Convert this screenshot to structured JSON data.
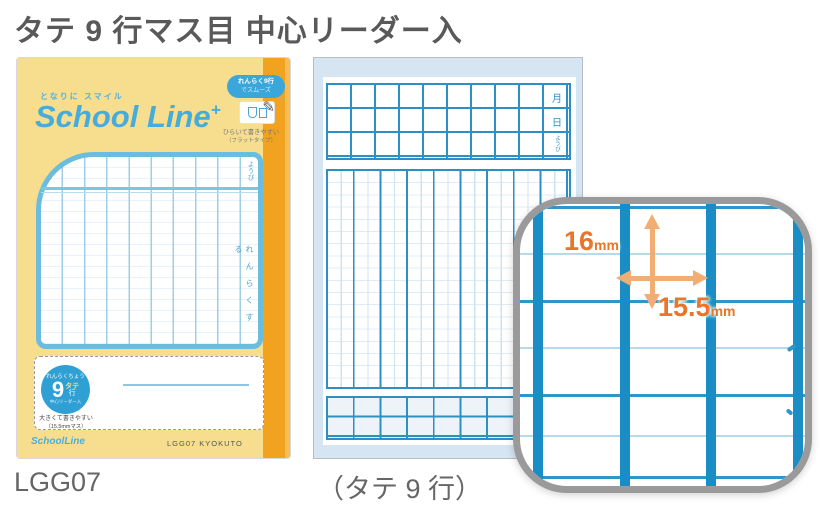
{
  "page": {
    "title": "タテ 9 行マス目 中心リーダー入",
    "product_code": "LGG07",
    "variant_caption": "（タテ 9 行）"
  },
  "cover": {
    "tagline": "となりに スマイル",
    "brand": "School Line",
    "brand_plus": "+",
    "feature_pill_line1": "れんらく9行",
    "feature_pill_line2": "でスムーズ",
    "feature_caption_line1": "ひらいて書きやすい",
    "feature_caption_line2": "（フラットタイプ）",
    "panel_label_top_right": "ようび",
    "panel_label_side": "れんらくする",
    "badge_arc_top": "れんらくちょう",
    "badge_number": "9",
    "badge_unit_1": "タテ",
    "badge_unit_2": "行",
    "badge_arc_bottom": "中心リーダー入",
    "plate_caption_line1": "大きくて書きやすい",
    "plate_caption_line2": "（15.5mmマス）",
    "footer_brand": "SchoolLine",
    "footer_maker": "LGG07 KYOKUTO"
  },
  "inner_page": {
    "header_label_1": "月",
    "header_label_2": "日",
    "header_label_3": "ようび"
  },
  "detail": {
    "vertical_value": "16",
    "vertical_unit": "mm",
    "horizontal_value": "15.5",
    "horizontal_unit": "mm"
  },
  "colors": {
    "brand_blue": "#45ACDB",
    "grid_blue": "#2E8FC4",
    "cover_yellow": "#F6DE8E",
    "spine_orange": "#F1A320",
    "page_blue": "#D5E5F2",
    "dimension_orange": "#E8752A",
    "detail_border_gray": "#9A9A9A"
  }
}
